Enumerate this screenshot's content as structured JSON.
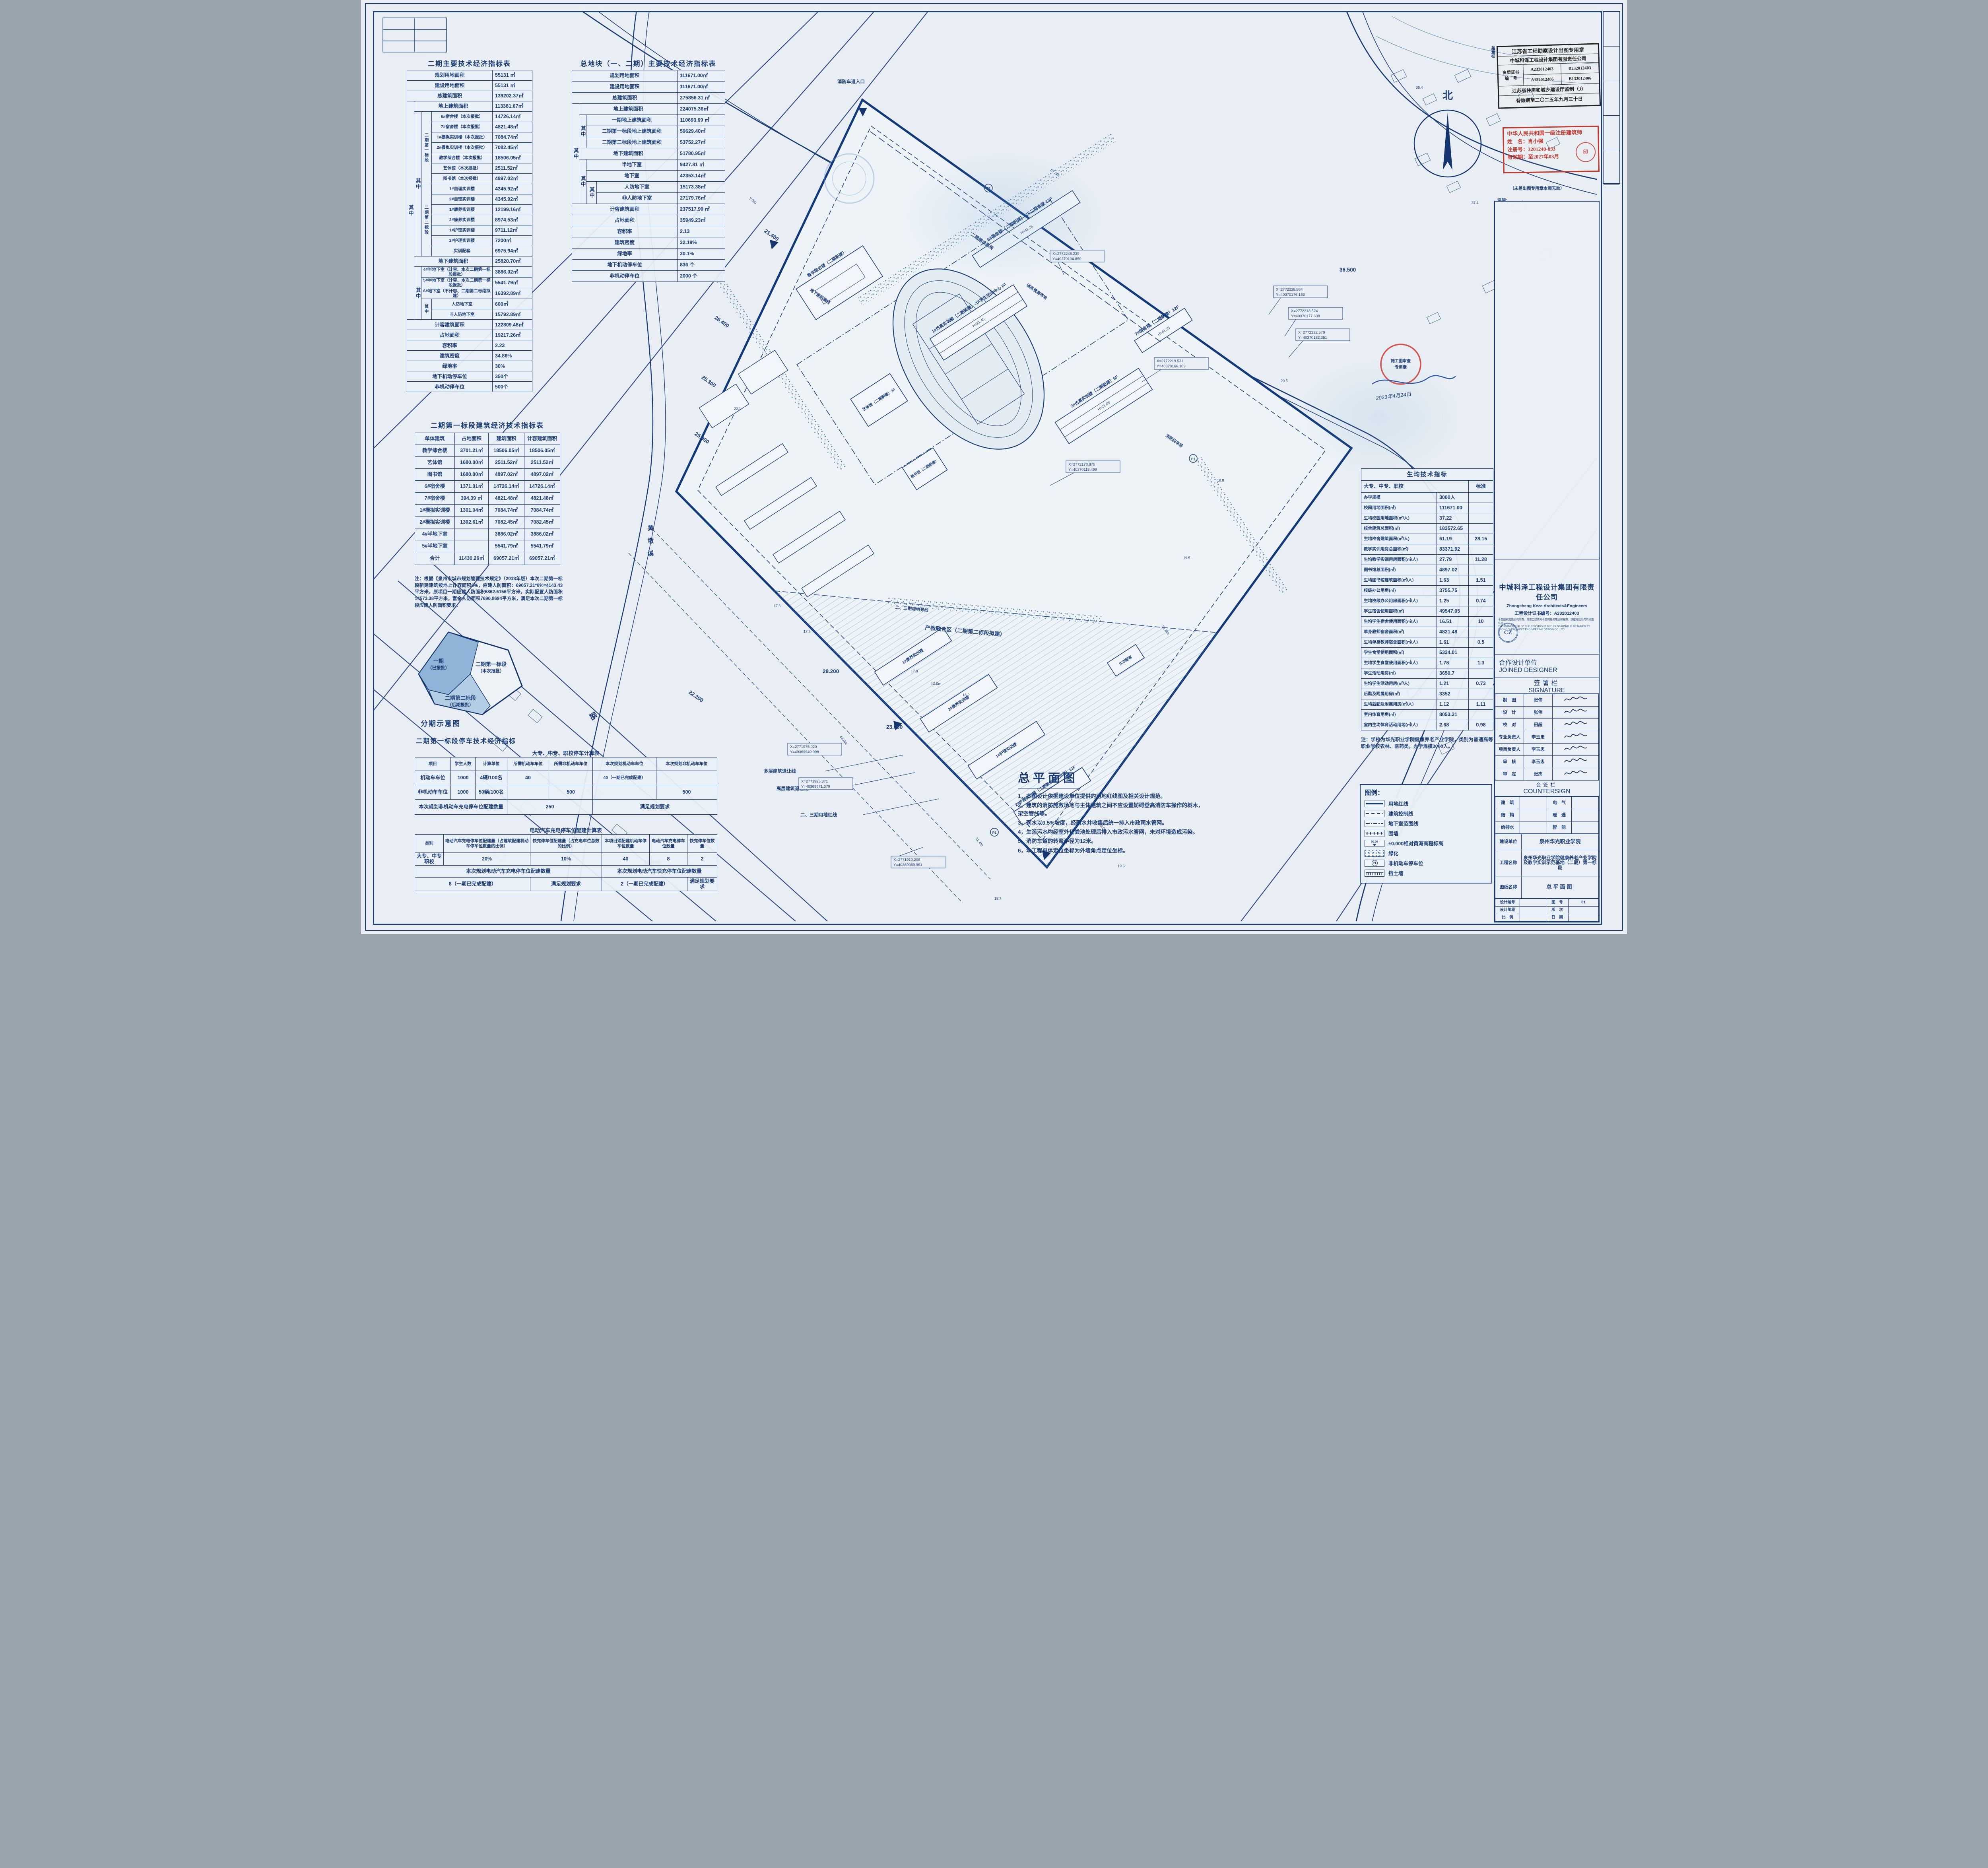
{
  "sheet": {
    "north": "北"
  },
  "t1": {
    "title": "二期主要技术经济指标表",
    "g": {
      "qz": "其中",
      "seg1": "二期第一标段",
      "seg2": "二期第二标段"
    },
    "rows": [
      {
        "l": "规划用地面积",
        "v": "55131 ㎡"
      },
      {
        "l": "建设用地面积",
        "v": "55131 ㎡"
      },
      {
        "l": "总建筑面积",
        "v": "139202.37㎡"
      },
      {
        "l": "地上建筑面积",
        "v": "113381.67㎡"
      },
      {
        "l": "6#宿舍楼（本次报批）",
        "v": "14726.14㎡"
      },
      {
        "l": "7#宿舍楼（本次报批）",
        "v": "4821.48㎡"
      },
      {
        "l": "1#模拟实训楼（本次报批）",
        "v": "7084.74㎡"
      },
      {
        "l": "2#模拟实训楼（本次报批）",
        "v": "7082.45㎡"
      },
      {
        "l": "教学综合楼（本次报批）",
        "v": "18506.05㎡"
      },
      {
        "l": "艺体馆（本次报批）",
        "v": "2511.52㎡"
      },
      {
        "l": "图书馆（本次报批）",
        "v": "4897.02㎡"
      },
      {
        "l": "1#自理实训楼",
        "v": "4345.92㎡"
      },
      {
        "l": "2#自理实训楼",
        "v": "4345.92㎡"
      },
      {
        "l": "1#康养实训楼",
        "v": "12199.16㎡"
      },
      {
        "l": "2#康养实训楼",
        "v": "8974.53㎡"
      },
      {
        "l": "1#护理实训楼",
        "v": "9711.12㎡"
      },
      {
        "l": "2#护理实训楼",
        "v": "7200㎡"
      },
      {
        "l": "实训配套",
        "v": "6975.94㎡"
      },
      {
        "l": "地下建筑面积",
        "v": "25820.70㎡"
      },
      {
        "l": "4#半地下室（计容、本次二期第一标段报批）",
        "v": "3886.02㎡"
      },
      {
        "l": "5#半地下室（计容、本次二期第一标段报批）",
        "v": "5541.79㎡"
      },
      {
        "l": "6#地下室（不计容、二期第二标段拟建）",
        "v": "16392.89㎡"
      },
      {
        "l": "人防地下室",
        "v": "600㎡"
      },
      {
        "l": "非人防地下室",
        "v": "15792.89㎡"
      },
      {
        "l": "计容建筑面积",
        "v": "122809.48㎡"
      },
      {
        "l": "占地面积",
        "v": "19217.26㎡"
      },
      {
        "l": "容积率",
        "v": "2.23"
      },
      {
        "l": "建筑密度",
        "v": "34.86%"
      },
      {
        "l": "绿地率",
        "v": "30%"
      },
      {
        "l": "地下机动停车位",
        "v": "350个"
      },
      {
        "l": "非机动停车位",
        "v": "500个"
      }
    ]
  },
  "t2": {
    "title": "总地块（一、二期）主要技术经济指标表",
    "qz": "其中",
    "rows": [
      {
        "l": "规划用地面积",
        "v": "111671.00㎡"
      },
      {
        "l": "建设用地面积",
        "v": "111671.00㎡"
      },
      {
        "l": "总建筑面积",
        "v": "275856.31 ㎡"
      },
      {
        "l": "地上建筑面积",
        "v": "224075.36㎡"
      },
      {
        "l": "一期地上建筑面积",
        "v": "110693.69 ㎡"
      },
      {
        "l": "二期第一标段地上建筑面积",
        "v": "59629.40㎡"
      },
      {
        "l": "二期第二标段地上建筑面积",
        "v": "53752.27㎡"
      },
      {
        "l": "地下建筑面积",
        "v": "51780.95㎡"
      },
      {
        "l": "半地下室",
        "v": "9427.81 ㎡"
      },
      {
        "l": "地下室",
        "v": "42353.14㎡"
      },
      {
        "l": "人防地下室",
        "v": "15173.38㎡"
      },
      {
        "l": "非人防地下室",
        "v": "27179.76㎡"
      },
      {
        "l": "计容建筑面积",
        "v": "237517.99 ㎡"
      },
      {
        "l": "占地面积",
        "v": "35949.23㎡"
      },
      {
        "l": "容积率",
        "v": "2.13"
      },
      {
        "l": "建筑密度",
        "v": "32.19%"
      },
      {
        "l": "绿地率",
        "v": "30.1%"
      },
      {
        "l": "地下机动停车位",
        "v": "836 个"
      },
      {
        "l": "非机动停车位",
        "v": "2000 个"
      }
    ]
  },
  "t3": {
    "title": "二期第一标段建筑经济技术指标表",
    "head": [
      "单体建筑",
      "占地面积",
      "建筑面积",
      "计容建筑面积"
    ],
    "rows": [
      [
        "教学综合楼",
        "3701.21㎡",
        "18506.05㎡",
        "18506.05㎡"
      ],
      [
        "艺体馆",
        "1680.00㎡",
        "2511.52㎡",
        "2511.52㎡"
      ],
      [
        "图书馆",
        "1680.00㎡",
        "4897.02㎡",
        "4897.02㎡"
      ],
      [
        "6#宿舍楼",
        "1371.01㎡",
        "14726.14㎡",
        "14726.14㎡"
      ],
      [
        "7#宿舍楼",
        "394.39 ㎡",
        "4821.48㎡",
        "4821.48㎡"
      ],
      [
        "1#模拟实训楼",
        "1301.04㎡",
        "7084.74㎡",
        "7084.74㎡"
      ],
      [
        "2#模拟实训楼",
        "1302.61㎡",
        "7082.45㎡",
        "7082.45㎡"
      ],
      [
        "4#半地下室",
        "",
        "3886.02㎡",
        "3886.02㎡"
      ],
      [
        "5#半地下室",
        "",
        "5541.79㎡",
        "5541.79㎡"
      ]
    ],
    "total": [
      "合计",
      "11430.26㎡",
      "69057.21㎡",
      "69057.21㎡"
    ]
  },
  "note1": {
    "head": "注：",
    "body": "根据《泉州市城市规划管理技术规定》（2018年版）本次二期第一标段新建建筑按地上计容面积6%，应建人防面积：69057.21*6%=4143.43平方米，原项目一期应建人防面积6862.6156平方米，实际配置人防面积14573.38平方米，富余人防面积7690.8694平方米，满足本次二期第一标段应建人防面积要求。"
  },
  "phasing": {
    "caption": "分期示意图",
    "z1a": "一期",
    "z1b": "（已报批）",
    "z2a": "二期第一标段",
    "z2b": "（本次报批）",
    "z3a": "二期第二标段",
    "z3b": "（后期报批）"
  },
  "parking": {
    "title": "二期第一标段停车技术经济指标",
    "a": {
      "title": "大专、中专、职校停车计算表",
      "head": [
        "项目",
        "学生人数",
        "计算单位",
        "所需机动车车位",
        "所需非机动车车位",
        "本次规划机动车车位",
        "本次规划非机动车车位"
      ],
      "rows": [
        [
          "机动车车位",
          "1000",
          "4辆/100名",
          "40",
          "",
          "40（一期已完成配建）",
          ""
        ],
        [
          "非机动车车位",
          "1000",
          "50辆/100名",
          "",
          "500",
          "",
          "500"
        ]
      ],
      "foot": [
        "本次规划非机动车充电停车位配建数量",
        "250",
        "满足规划要求"
      ]
    },
    "b": {
      "title": "电动汽车充电停车位配建计算表",
      "head": [
        "类别",
        "电动汽车充电停车位配建量（占建筑配建机动车停车位数量的比例）",
        "快充停车位配建量（占充电车位总数的比例）",
        "本项目须配建机动车停车位数量",
        "电动汽车充电停车位数量",
        "快充停车位数量"
      ],
      "row": [
        "大专、中专职校",
        "20%",
        "10%",
        "40",
        "8",
        "2"
      ],
      "mid": [
        "本次规划电动汽车充电停车位配建数量",
        "本次规划电动汽车快充停车位配建数量"
      ],
      "foot": [
        "8（一期已完成配建）",
        "满足规划要求",
        "2（一期已完成配建）",
        "满足规划要求"
      ]
    }
  },
  "ps": {
    "title": "生均技术指标",
    "sub": "大专、中专、职校",
    "std": "标准",
    "rows": [
      [
        "办学规模",
        "3000人",
        ""
      ],
      [
        "校园用地面积(㎡)",
        "111671.00",
        ""
      ],
      [
        "生均校园用地面积(㎡/人)",
        "37.22",
        ""
      ],
      [
        "校舍建筑总面积(㎡)",
        "183572.65",
        ""
      ],
      [
        "生均校舍建筑面积(㎡/人)",
        "61.19",
        "28.15"
      ],
      [
        "教学实训用房总面积(㎡)",
        "83371.92",
        ""
      ],
      [
        "生均教学实训用房面积(㎡/人)",
        "27.79",
        "11.28"
      ],
      [
        "图书馆总面积(㎡)",
        "4897.02",
        ""
      ],
      [
        "生均图书馆建筑面积(㎡/人)",
        "1.63",
        "1.51"
      ],
      [
        "校级办公用房(㎡)",
        "3755.75",
        ""
      ],
      [
        "生均校级办公用房面积(㎡/人)",
        "1.25",
        "0.74"
      ],
      [
        "学生宿舍使用面积(㎡)",
        "49547.05",
        ""
      ],
      [
        "生均学生宿舍使用面积(㎡/人)",
        "16.51",
        "10"
      ],
      [
        "单身教师宿舍面积(㎡)",
        "4821.48",
        ""
      ],
      [
        "生均单身教师宿舍面积(㎡/人)",
        "1.61",
        "0.5"
      ],
      [
        "学生食堂使用面积(㎡)",
        "5334.01",
        ""
      ],
      [
        "生均学生食堂使用面积(㎡/人)",
        "1.78",
        "1.3"
      ],
      [
        "学生活动用房(㎡)",
        "3650.7",
        ""
      ],
      [
        "生均学生活动用房(㎡/人)",
        "1.21",
        "0.73"
      ],
      [
        "后勤及附属用房(㎡)",
        "3352",
        ""
      ],
      [
        "生均后勤及附属用房(㎡/人)",
        "1.12",
        "1.11"
      ],
      [
        "室内体育用房(㎡)",
        "8053.31",
        ""
      ],
      [
        "室内生均体育活动用地(㎡/人)",
        "2.68",
        "0.98"
      ]
    ]
  },
  "ps_note": {
    "head": "注：",
    "body": "学校为华光职业学院健康养老产业学院，类别为普通高等职业学校农林、医药类，办学规模3000人。"
  },
  "main_title": "总平面图",
  "notes": [
    "1，本图设计依据建设单位提供的用地红线图及相关设计规范。",
    "2，建筑的消防施救场地与主体建筑之间不应设置妨碍登高消防车操作的树木，架空管线等。",
    "3，雨水以0.5%坡度，经雨水井收集后统一排入市政雨水管网。",
    "4，生活污水均经室外化粪池处理后排入市政污水管网，未对环境造成污染。",
    "5，消防车道的转弯半径为12米。",
    "6，本工程单体定位坐标为外墙角点定位坐标。"
  ],
  "legend": {
    "title": "图例：",
    "items": [
      {
        "label": "用地红线",
        "type": "redline"
      },
      {
        "label": "建筑控制线",
        "type": "ctrl"
      },
      {
        "label": "地下室范围线",
        "type": "base"
      },
      {
        "label": "围墙",
        "type": "fence"
      },
      {
        "label": "±0.000相对黄海高程标高",
        "type": "datum",
        "sym": "50.00"
      },
      {
        "label": "绿化",
        "type": "green"
      },
      {
        "label": "非机动车停车位",
        "type": "p1",
        "sym": "P1"
      },
      {
        "label": "挡土墙",
        "type": "retain"
      }
    ]
  },
  "stamps": {
    "gz": "盖章栏",
    "black": {
      "t": "江苏省工程勘察设计出图专用章",
      "c": "中城科泽工程设计集团有限责任公司",
      "zl": "资质证书",
      "zl2": "编　号",
      "n1": "A232012403",
      "n2": "B232012403",
      "n3": "A132012406",
      "n4": "B132012406",
      "j": "江苏省住房和城乡建设厅监制（J）",
      "exp": "有效期至二〇二五年九月三十日"
    },
    "red": {
      "t": "中华人民共和国一级注册建筑师",
      "name": "姓　名：肖小强",
      "reg": "注册号：3201240-033",
      "exp": "有效期：至2027年03月",
      "seal": "印"
    },
    "invalid": "（未盖出图专用章本图无效）",
    "sm": "说明：",
    "review": {
      "a": "施工图审查",
      "b": "专用章",
      "date": "2023年4月24日"
    }
  },
  "tb": {
    "company": "中城科泽工程设计集团有限责任公司",
    "company_en": "Zhongcheng Keze Architects&Engineers",
    "cert": "工程设计证书编号：A232012403",
    "copy": "本图版权属我公司所有，除该工程外对本图的任何用途和复制，须征得我公司的书面许可",
    "copy_en": "THE OWNERSHIP OF THE COPYRIGHT IN THIS DRAWING IS RETAINED BY ZHONGCHENG KEZE ENGINEERING DESIGN CO.,LTD",
    "logo": "CZ",
    "joined": "合作设计单位",
    "joined_en": "JOINED DESIGNER",
    "sign": "签署栏",
    "sign_en": "SIGNATURE",
    "sig_rows": [
      {
        "r": "制　图",
        "n": "张伟"
      },
      {
        "r": "设　计",
        "n": "张伟"
      },
      {
        "r": "校　对",
        "n": "田超"
      },
      {
        "r": "专业负责人",
        "n": "李玉忠"
      },
      {
        "r": "项目负责人",
        "n": "李玉忠"
      },
      {
        "r": "审　核",
        "n": "李玉忠"
      },
      {
        "r": "审　定",
        "n": "张杰"
      }
    ],
    "hq": "会签栏",
    "hq_en": "COUNTERSIGN",
    "hq_rows": [
      [
        "建　筑",
        "电　气"
      ],
      [
        "结　构",
        "暖　通"
      ],
      [
        "给排水",
        "智　能"
      ]
    ],
    "client_l": "建设单位",
    "client": "泉州华光职业学院",
    "proj_l": "工程名称",
    "proj": "泉州华光职业学院健康养老产业学院及教学实训示范基地（二期）第一标段",
    "draw_l": "图纸名称",
    "draw": "总平面图",
    "rows3": [
      {
        "a": "设计编号",
        "b": "",
        "c": "图　号",
        "d": "01"
      },
      {
        "a": "设计阶段",
        "b": "",
        "c": "版　次",
        "d": ""
      },
      {
        "a": "比　例",
        "b": "",
        "c": "日　期",
        "d": ""
      }
    ]
  },
  "plan": {
    "p1": "P1",
    "labels": {
      "fire_entry": "消防车道入口",
      "denggao": "消防登高场地",
      "huiche": "消防回车场",
      "phase2line": "二期建设界线",
      "phase23line": "二、三期用地界线",
      "basement": "地下室范围线",
      "fusion": "产教融合区（二期第二标段拟建）",
      "tall_setback": "高层建筑退让线",
      "multi_setback": "多层建筑退让线",
      "phase23red": "二、三期用地红线"
    },
    "buildings": [
      {
        "label": "6#宿舍楼（二期新建）-1F二期食堂 12F",
        "h": "H=41.25"
      },
      {
        "label": "7#宿舍楼（二期新建）12F",
        "h": "H=41.25"
      },
      {
        "label": "1#仿真实训楼（二期新建）-1F学生活动中心 6F",
        "h": "H=21.45"
      },
      {
        "label": "2#仿真实训楼（二期新建）6F",
        "h": "H=21.45"
      },
      {
        "label": "教学综合楼（二期新建）"
      },
      {
        "label": "艺体馆（二期新建）3F"
      },
      {
        "label": "图书馆（二期新建）"
      },
      {
        "label": "1#康养实训楼"
      },
      {
        "label": "2#康养实训楼"
      },
      {
        "label": "1#护理实训楼"
      },
      {
        "label": "2#护理实训楼（二期第二标段拟建）12F",
        "h": "H=46.30"
      },
      {
        "label": "实训配套"
      }
    ],
    "coords": [
      {
        "x": "X=2772248.239",
        "y": "Y=40370104.850"
      },
      {
        "x": "X=2772238.864",
        "y": "Y=40370176.183"
      },
      {
        "x": "X=2772213.524",
        "y": "Y=40370177.638"
      },
      {
        "x": "X=2772222.570",
        "y": "Y=40370182.351"
      },
      {
        "x": "X=2772219.531",
        "y": "Y=40370166.109"
      },
      {
        "x": "X=2772178.875",
        "y": "Y=40370118.499"
      },
      {
        "x": "X=2771975.020",
        "y": "Y=40369940.998"
      },
      {
        "x": "X=2771925.371",
        "y": "Y=40369971.379"
      },
      {
        "x": "X=2771910.208",
        "y": "Y=40369989.961"
      }
    ],
    "levels": [
      "21.400",
      "26.400",
      "25.300",
      "25.000",
      "28.200",
      "23.000",
      "36.500",
      "19.400",
      "22.200"
    ],
    "dims": [
      "7.0m",
      "12.0m",
      "40.0m",
      "44.0m",
      "21.8m",
      "11.4m",
      "57.8m"
    ],
    "spots": [
      "17.6",
      "17.7",
      "17.8",
      "18.2",
      "19.5",
      "18.8",
      "22.1",
      "36.4",
      "37.4",
      "19.6",
      "20.5",
      "18.7"
    ],
    "river": [
      "黄",
      "墩",
      "溪"
    ],
    "road": "路"
  }
}
